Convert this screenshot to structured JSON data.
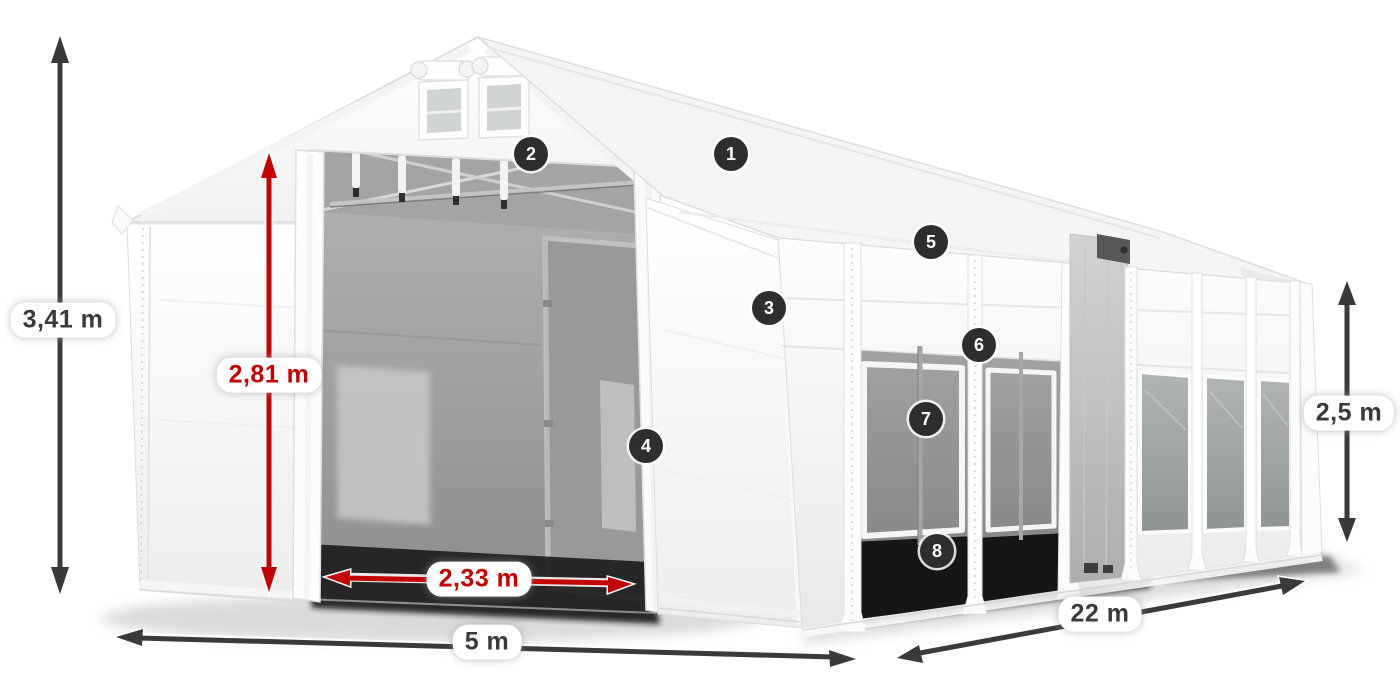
{
  "diagram": {
    "background": "#ffffff",
    "accent_red": "#c40000",
    "annotation_dark": "#3a3a3c",
    "marker_background": "#2e2e2e",
    "marker_text": "#ffffff"
  },
  "measurements": {
    "total_height": "3,41 m",
    "entrance_height": "2,81 m",
    "entrance_width": "2,33 m",
    "front_width": "5 m",
    "side_length": "22 m",
    "side_height": "2,5 m"
  },
  "markers": [
    {
      "number": "1"
    },
    {
      "number": "2"
    },
    {
      "number": "3"
    },
    {
      "number": "4"
    },
    {
      "number": "5"
    },
    {
      "number": "6"
    },
    {
      "number": "7"
    },
    {
      "number": "8"
    }
  ]
}
